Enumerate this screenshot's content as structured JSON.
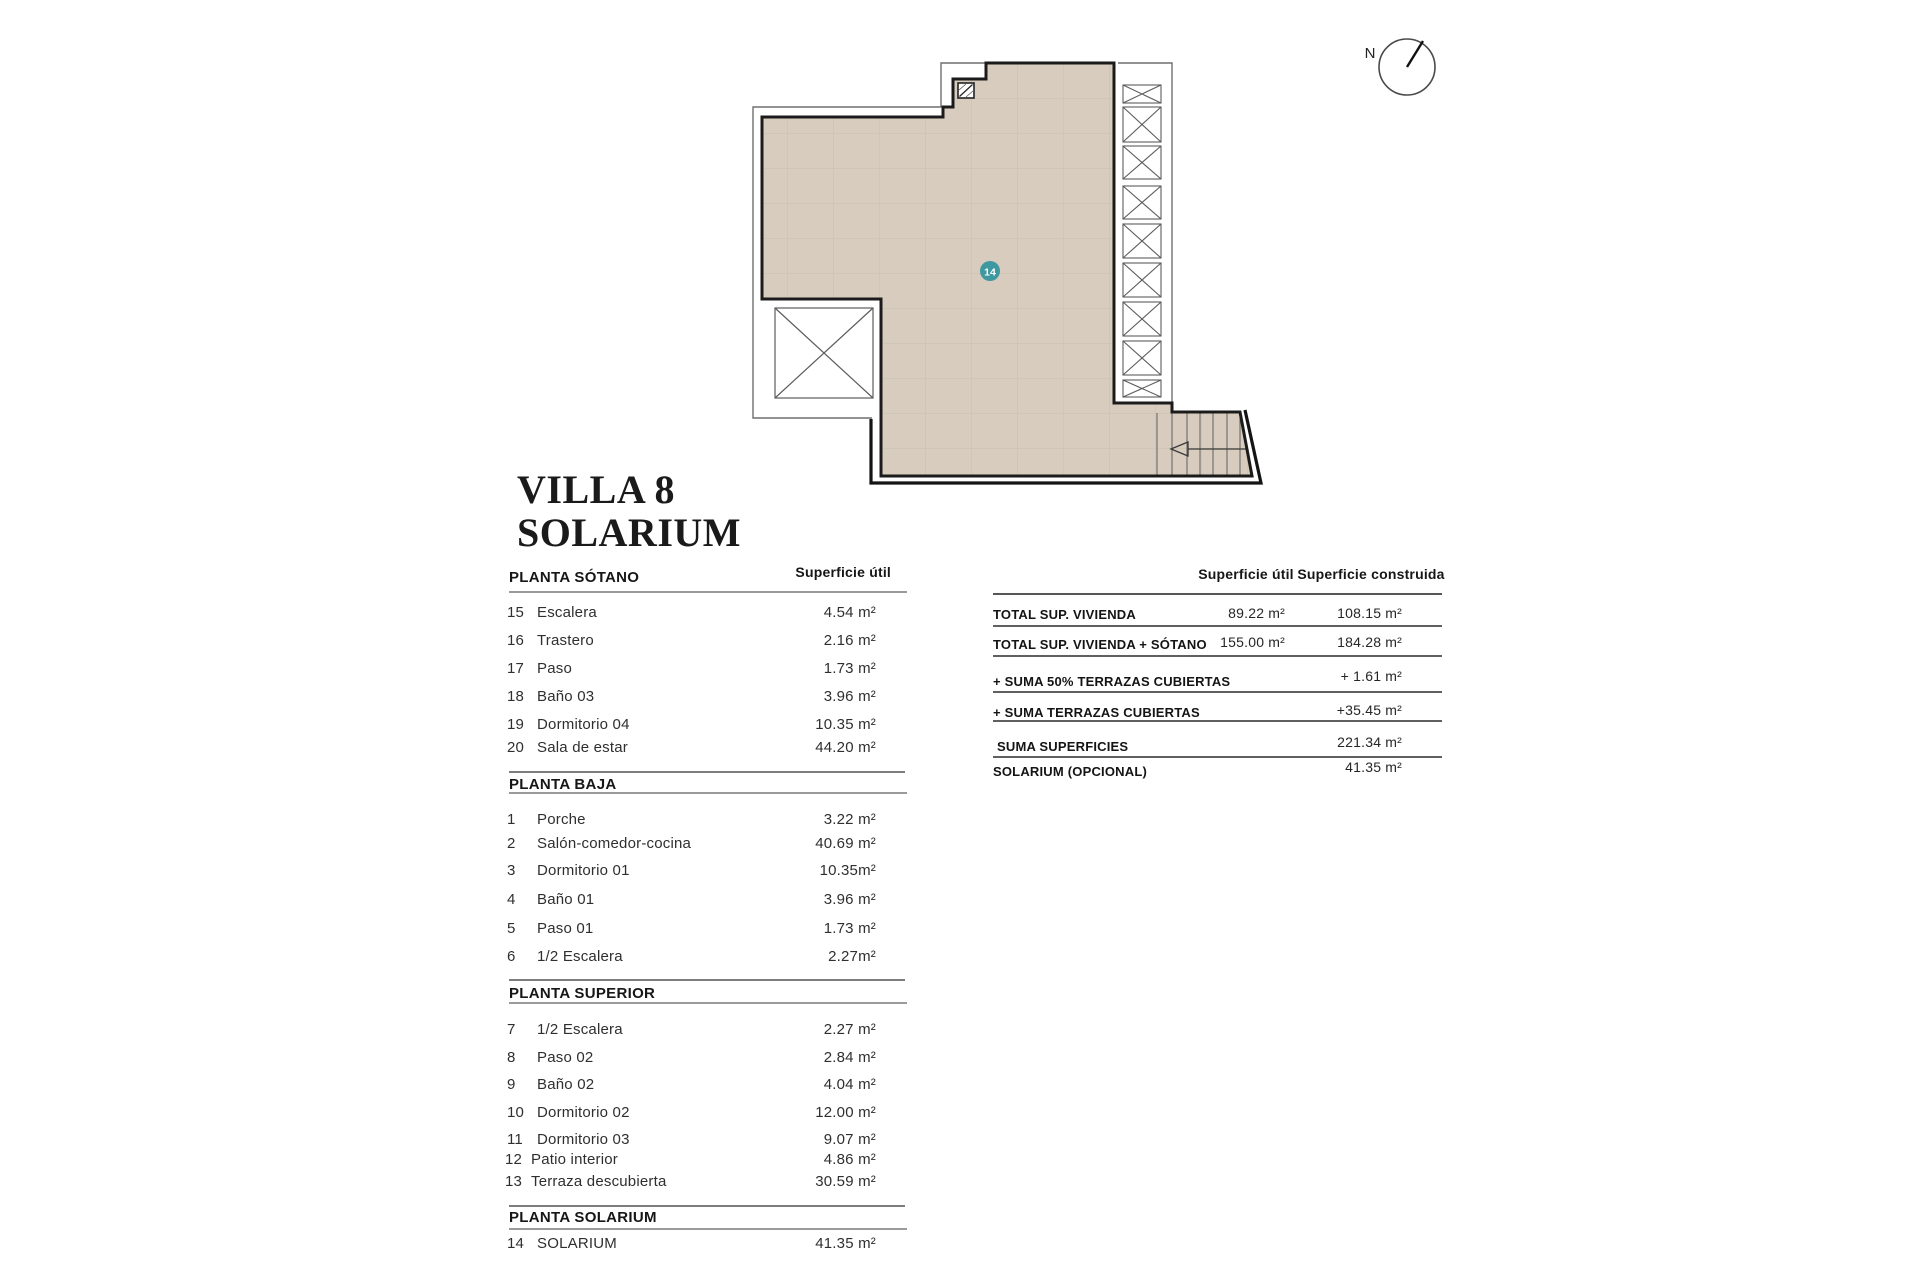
{
  "title": {
    "line1": "VILLA 8",
    "line2": "SOLARIUM"
  },
  "plan": {
    "badge": "14",
    "north": "N"
  },
  "rooms_table": {
    "area_header": "Superficie útil",
    "sections": [
      {
        "name": "PLANTA SÓTANO",
        "rows": [
          {
            "num": "15",
            "label": "Escalera",
            "value": "4.54 m²"
          },
          {
            "num": "16",
            "label": "Trastero",
            "value": "2.16 m²"
          },
          {
            "num": "17",
            "label": "Paso",
            "value": "1.73 m²"
          },
          {
            "num": "18",
            "label": "Baño 03",
            "value": "3.96 m²"
          },
          {
            "num": "19",
            "label": "Dormitorio 04",
            "value": "10.35 m²"
          },
          {
            "num": "20",
            "label": "Sala de estar",
            "value": "44.20 m²"
          }
        ]
      },
      {
        "name": "PLANTA BAJA",
        "rows": [
          {
            "num": "1",
            "label": "Porche",
            "value": "3.22 m²"
          },
          {
            "num": "2",
            "label": "Salón-comedor-cocina",
            "value": "40.69 m²"
          },
          {
            "num": "3",
            "label": "Dormitorio 01",
            "value": "10.35m²"
          },
          {
            "num": "4",
            "label": "Baño 01",
            "value": "3.96 m²"
          },
          {
            "num": "5",
            "label": "Paso 01",
            "value": "1.73 m²"
          },
          {
            "num": "6",
            "label": "1/2 Escalera",
            "value": "2.27m²"
          }
        ]
      },
      {
        "name": "PLANTA SUPERIOR",
        "rows": [
          {
            "num": "7",
            "label": "1/2 Escalera",
            "value": "2.27 m²"
          },
          {
            "num": "8",
            "label": "Paso 02",
            "value": "2.84 m²"
          },
          {
            "num": "9",
            "label": "Baño 02",
            "value": "4.04 m²"
          },
          {
            "num": "10",
            "label": "Dormitorio 02",
            "value": "12.00 m²"
          },
          {
            "num": "11",
            "label": "Dormitorio 03",
            "value": "9.07 m²"
          },
          {
            "num": "12",
            "label": "Patio interior",
            "value": "4.86 m²"
          },
          {
            "num": "13",
            "label": "Terraza descubierta",
            "value": "30.59 m²"
          }
        ]
      },
      {
        "name": "PLANTA SOLARIUM",
        "rows": [
          {
            "num": "14",
            "label": "SOLARIUM",
            "value": "41.35 m²"
          }
        ]
      }
    ]
  },
  "summary_table": {
    "col_util": "Superficie útil",
    "col_construida": "Superficie construida",
    "rows": [
      {
        "label": "TOTAL SUP. VIVIENDA",
        "util": "89.22 m²",
        "construida": "108.15 m²"
      },
      {
        "label": "TOTAL SUP. VIVIENDA + SÓTANO",
        "util": "155.00  m²",
        "construida": "184.28 m²"
      },
      {
        "label": "+ SUMA 50% TERRAZAS CUBIERTAS",
        "util": "",
        "construida": "+ 1.61 m²"
      },
      {
        "label": "+ SUMA TERRAZAS CUBIERTAS",
        "util": "",
        "construida": "+35.45 m²"
      },
      {
        "label": "SUMA SUPERFICIES",
        "util": "",
        "construida": "221.34 m²"
      },
      {
        "label": "SOLARIUM (OPCIONAL)",
        "util": "",
        "construida": "41.35 m²"
      }
    ]
  },
  "colors": {
    "floor_fill": "#d7ccbd",
    "tile_grid": "#cabfae",
    "wall": "#1b1b1b",
    "badge": "#3e98a0"
  }
}
